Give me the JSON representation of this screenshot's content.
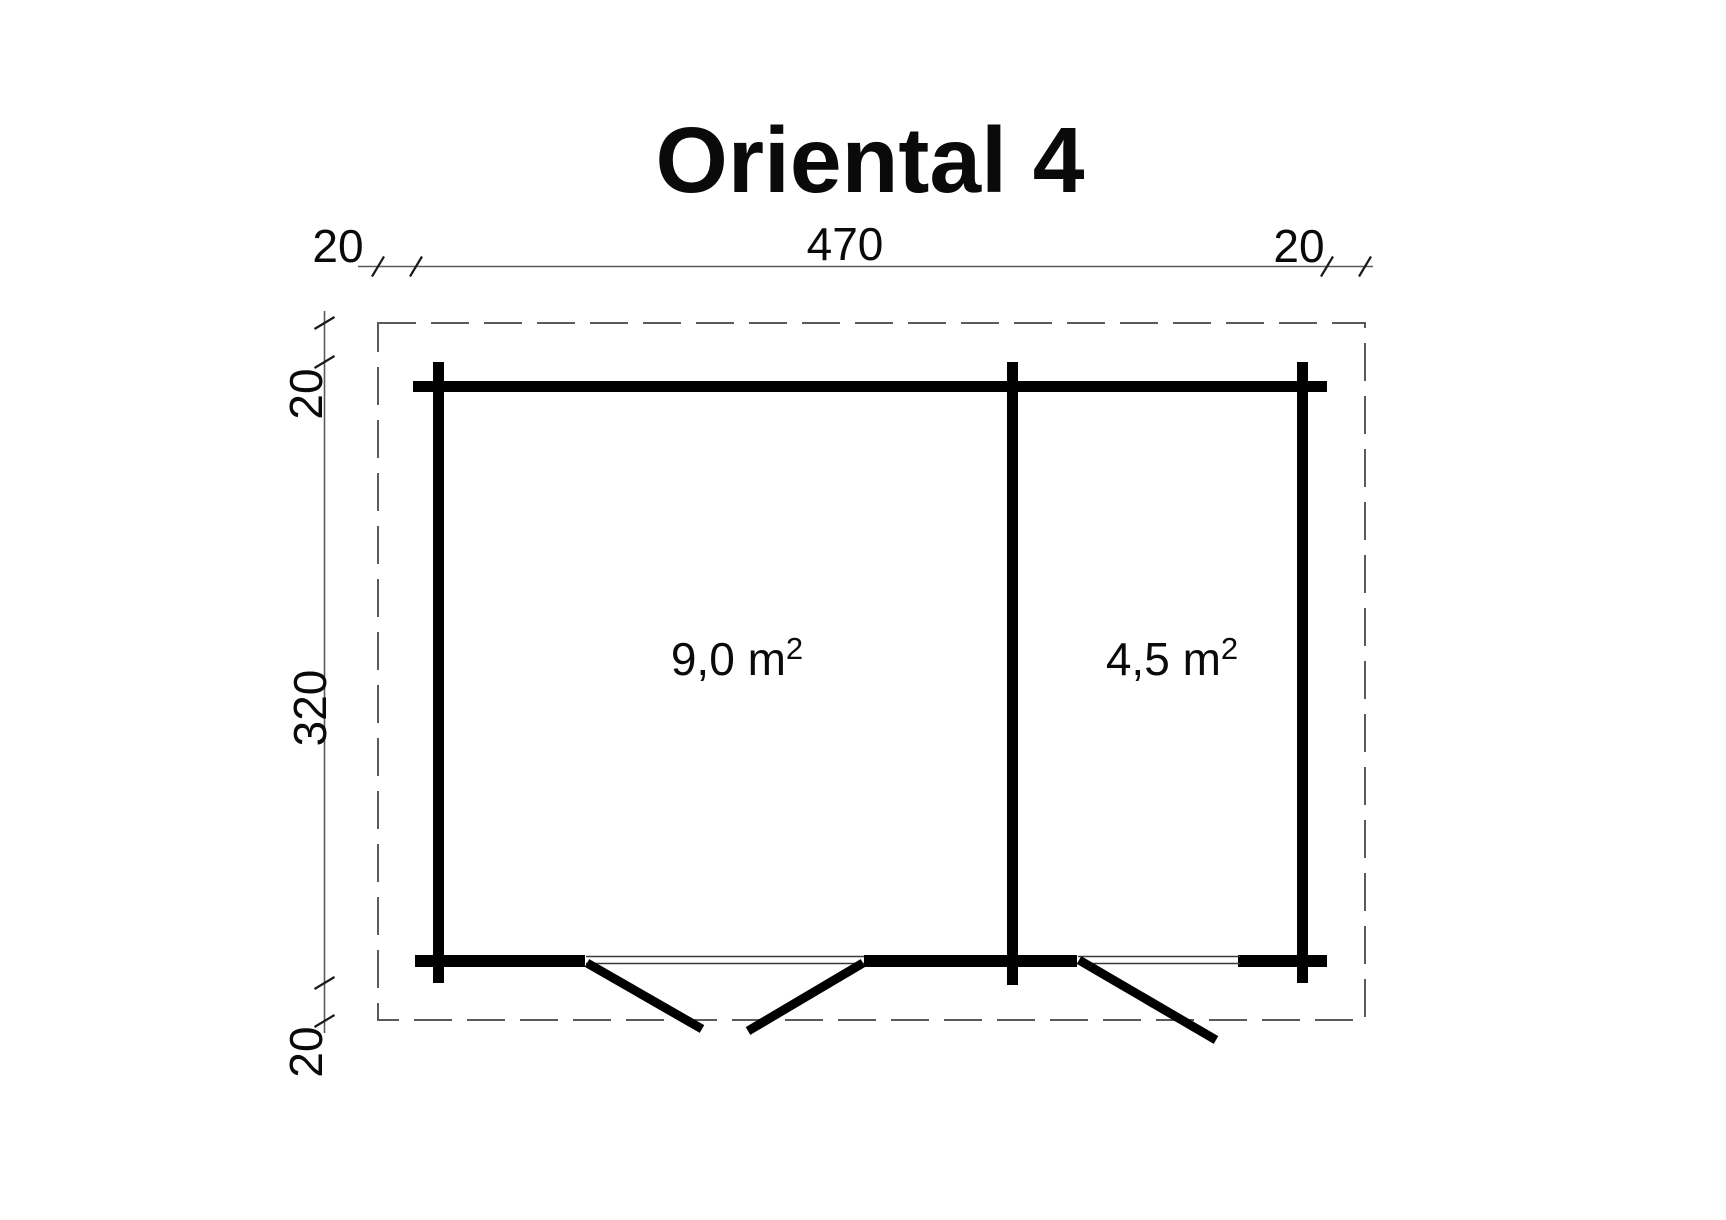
{
  "title": "Oriental 4",
  "dimensions": {
    "top_left_offset": "20",
    "top_width": "470",
    "top_right_offset": "20",
    "side_top_offset": "20",
    "side_height": "320",
    "side_bottom_offset": "20"
  },
  "rooms": [
    {
      "id": "main-room",
      "area": "9,0 m²",
      "area_base": "9,0 m",
      "area_sup": "2"
    },
    {
      "id": "side-room",
      "area": "4,5 m²",
      "area_base": "4,5 m",
      "area_sup": "2"
    }
  ],
  "colors": {
    "background": "#ffffff",
    "wall": "#000000",
    "thin_line": "#5a5a5a",
    "text": "#0a0a0a"
  }
}
